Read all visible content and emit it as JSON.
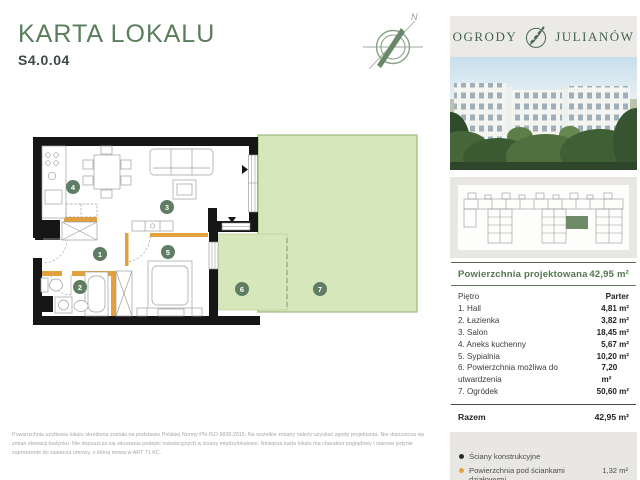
{
  "page": {
    "title": "KARTA LOKALU",
    "unit": "S4.0.04"
  },
  "compass": {
    "north_label": "N"
  },
  "brand": {
    "name_left": "OGRODY",
    "name_right": "JULIANÓW"
  },
  "summary": {
    "label": "Powierzchnia projektowana",
    "value": "42,95 m²"
  },
  "floor": {
    "label": "Piętro",
    "value": "Parter"
  },
  "rooms": [
    {
      "num": "1",
      "label": "1. Hall",
      "value": "4,81 m²"
    },
    {
      "num": "2",
      "label": "2. Łazienka",
      "value": "3,82 m²"
    },
    {
      "num": "3",
      "label": "3. Salon",
      "value": "18,45 m²"
    },
    {
      "num": "4",
      "label": "4. Aneks kuchenny",
      "value": "5,67 m²"
    },
    {
      "num": "5",
      "label": "5. Sypialnia",
      "value": "10,20 m²"
    },
    {
      "num": "6",
      "label": "6. Powierzchnia możliwa do utwardzenia",
      "value": "7,20 m²"
    },
    {
      "num": "7",
      "label": "7. Ogródek",
      "value": "50,60 m²"
    }
  ],
  "total": {
    "label": "Razem",
    "value": "42,95 m²"
  },
  "legend": {
    "items": [
      {
        "label": "Ściany konstrukcyjne",
        "sub": "",
        "value": "",
        "color": "#2b2b2b"
      },
      {
        "label": "Powierzchnia pod ściankami działowymi",
        "sub": "(nie płacisz za nią)",
        "value": "1,32 m²",
        "color": "#e8a33d"
      }
    ]
  },
  "footer": {
    "lines": [
      "Powierzchnia użytkowa lokalu określona została na podstawie Polskiej Normy PN-ISO 9836:2015. Na wszelkie zmiany należy uzyskać zgodę projektanta. Nie dopuszcza się",
      "zmian elewacji budynku. Nie dopuszcza się wkuwania podejść instalacyjnych w ściany międzylokalowe. Niniejsza karta lokalu ma charakter poglądowy i stanowi jedynie",
      "zaproszenie do zawarcia umowy, o której mowa w ART 71 KC."
    ]
  },
  "colors": {
    "accent_green": "#5a7e5b",
    "badge_green": "#5f7d62",
    "garden_fill": "#d7e7bc",
    "garden_border": "#9db97e",
    "partition_orange": "#e2a13c",
    "wall_black": "#161616",
    "panel_gray": "#e8e7e4"
  }
}
